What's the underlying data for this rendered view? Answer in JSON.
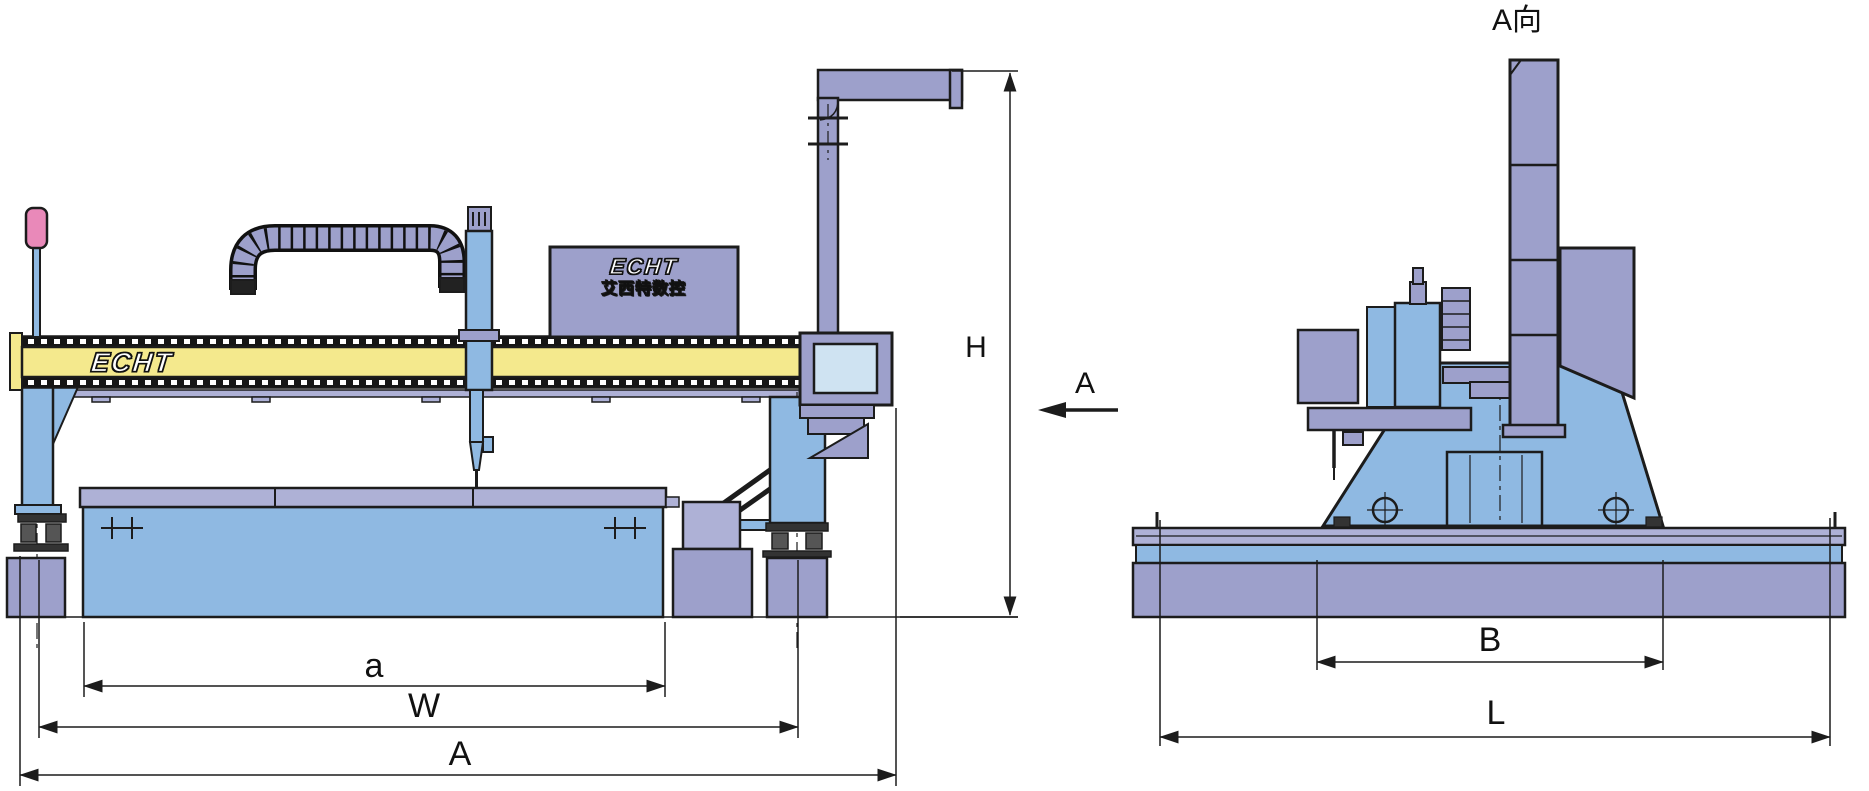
{
  "drawing_title": "gantry-cnc-cutting-machine-dimension-diagram",
  "front_view": {
    "beam_logo": "ECHT",
    "control_cabinet": {
      "logo": "ECHT",
      "subtitle": "艾西特数控"
    },
    "dimensions": {
      "effective_cutting_width": "a",
      "track_gauge": "W",
      "overall_width": "A",
      "overall_height": "H"
    }
  },
  "side_view": {
    "title": "A向",
    "dimensions": {
      "carriage_gauge": "B",
      "base_length": "L"
    }
  },
  "direction_arrow": {
    "label": "A"
  },
  "colors": {
    "beam_yellow": "#f4e98d",
    "panel_lavender": "#9da0cb",
    "panel_lavender_light": "#aeb1d6",
    "machine_blue": "#8fb9e2",
    "screen_blue": "#cfe3f2",
    "signal_pink": "#e989b9",
    "outline": "#1c1c1c"
  }
}
